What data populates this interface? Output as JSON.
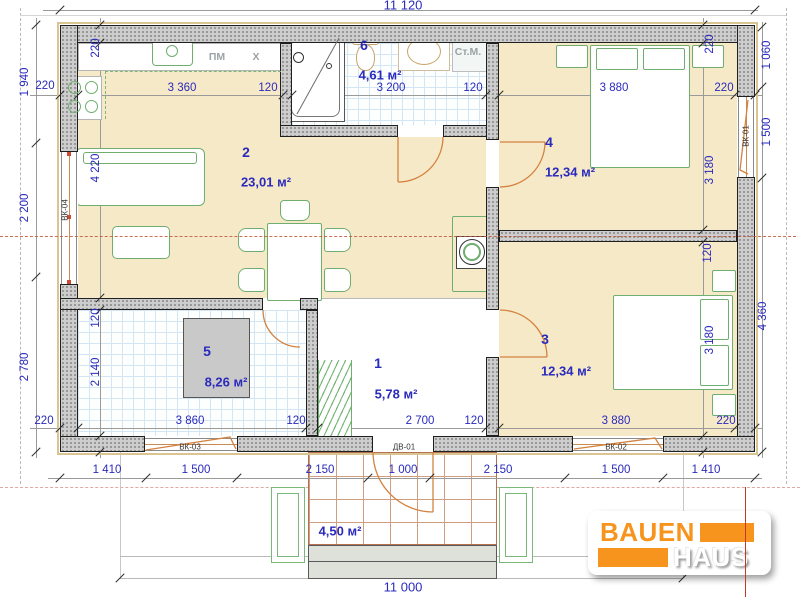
{
  "plan": {
    "rooms": [
      {
        "number": "1",
        "area": "5,78 м²"
      },
      {
        "number": "2",
        "area": "23,01 м²"
      },
      {
        "number": "3",
        "area": "12,34 м²"
      },
      {
        "number": "4",
        "area": "12,34 м²"
      },
      {
        "number": "5",
        "area": "8,26 м²"
      },
      {
        "number": "6",
        "area": "4,61 м²"
      }
    ],
    "porch_area": "4,50 м²",
    "appliance_labels": {
      "dishwasher": "ПМ",
      "fridge": "X",
      "washing_machine": "Ст.М."
    },
    "opening_labels": {
      "vk01": "ВК-01",
      "vk02": "ВК-02",
      "vk03": "ВК-03",
      "vk04": "ВК-04",
      "dv01": "ДВ-01"
    }
  },
  "dimensions": {
    "top_total": "11 120",
    "bottom_total": "11 000",
    "top_row": [
      "220",
      "3 360",
      "120",
      "3 200",
      "120",
      "3 880",
      "220"
    ],
    "bottom_row": [
      "220",
      "3 860",
      "120",
      "2 700",
      "120",
      "3 880",
      "220"
    ],
    "bottom_outer_row": [
      "1 410",
      "1 500",
      "2 150",
      "1 000",
      "2 150",
      "1 500",
      "1 410"
    ],
    "left_outer": [
      "1 940",
      "2 200",
      "2 780"
    ],
    "left_inner": [
      "220",
      "4 220",
      "120",
      "2 140"
    ],
    "right_outer": [
      "1 060",
      "1 500",
      "4 360"
    ],
    "right_inner": [
      "220",
      "3 180",
      "120",
      "3 180"
    ]
  },
  "logo": {
    "line1": "BAUEN",
    "line2": "HAUS",
    "accent_color": "#F7941D"
  },
  "colors": {
    "room_fill": "#F6E9C8",
    "dimension_text": "#2A2ABD",
    "furniture_outline": "#6FAE6F",
    "wall_hatch": "#CDCDCD",
    "section_line": "#C0563C",
    "tile_line": "#D4E5F3"
  }
}
